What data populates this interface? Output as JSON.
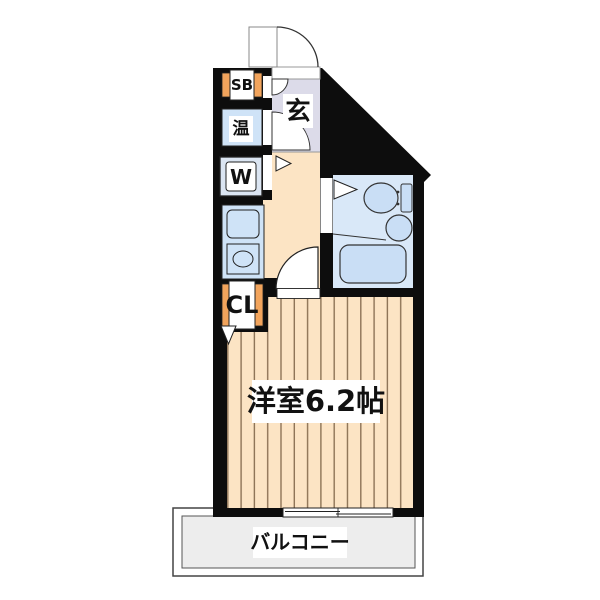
{
  "floorplan": {
    "labels": {
      "shoe_box": "SB",
      "water_heater": "温",
      "washer": "W",
      "closet": "CL",
      "entrance": "玄",
      "main_room": "洋室6.2帖",
      "balcony": "バルコニー"
    },
    "colors": {
      "wall": "#0d0d0d",
      "floor": "#fce4c4",
      "floor_stripe": "#8d7356",
      "genkan": "#dcdbe9",
      "bath": "#d9e8f8",
      "fixture": "#c9def5",
      "kitchen_unit": "#cfe3f7",
      "accent_orange": "#f2a45c",
      "balcony_floor": "#ededed"
    }
  }
}
